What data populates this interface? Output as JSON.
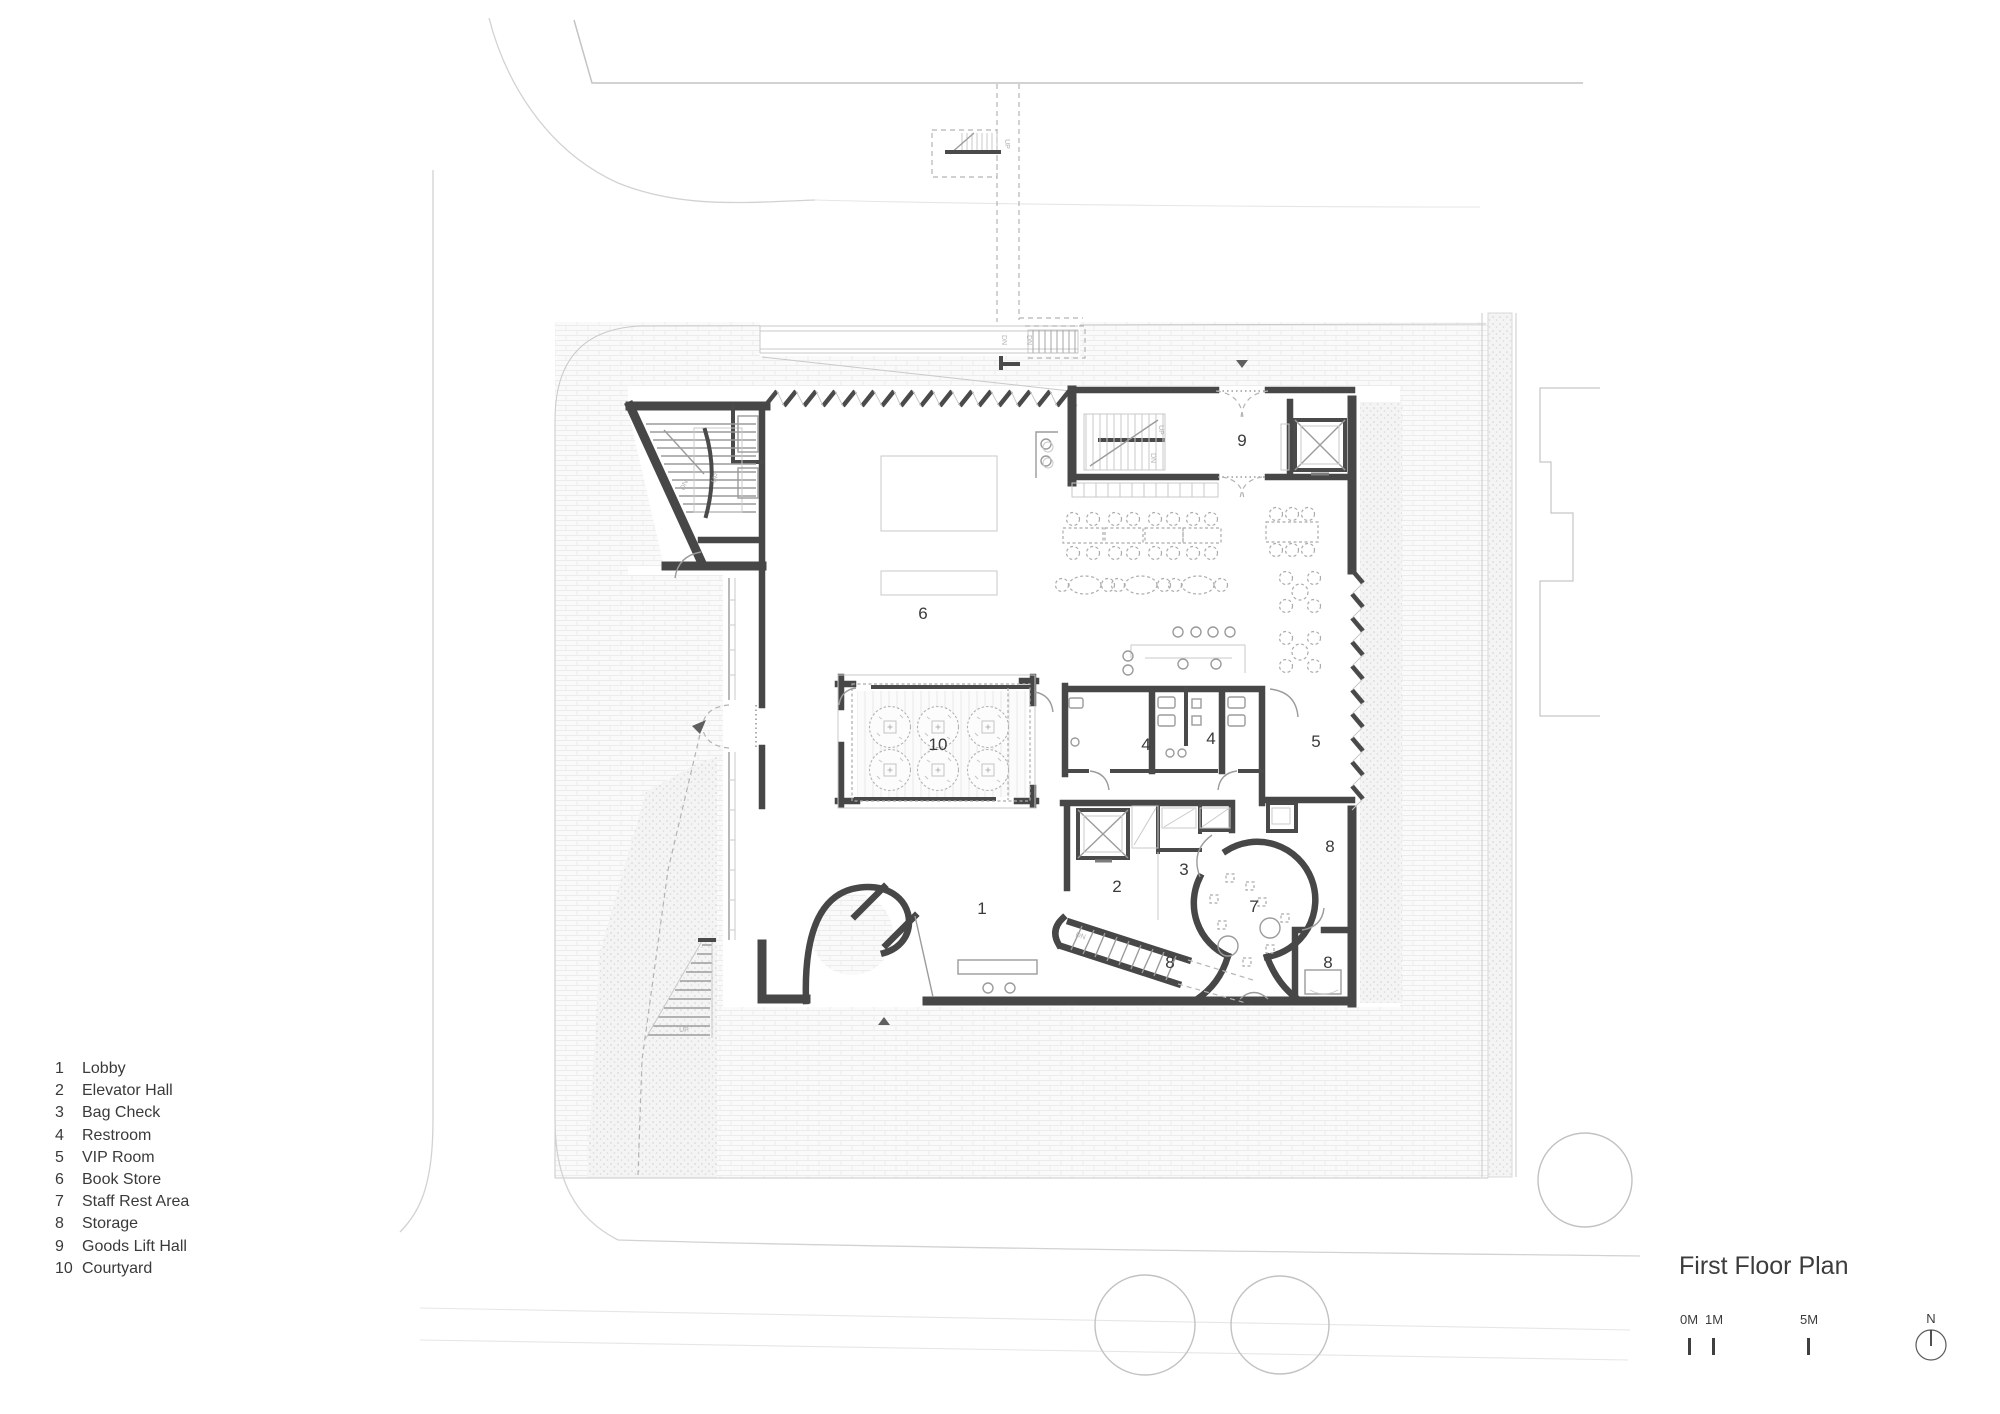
{
  "document": {
    "type": "architectural floor plan drawing"
  },
  "title": "First Floor Plan",
  "legend": {
    "items": [
      {
        "num": "1",
        "label": "Lobby"
      },
      {
        "num": "2",
        "label": "Elevator Hall"
      },
      {
        "num": "3",
        "label": "Bag Check"
      },
      {
        "num": "4",
        "label": "Restroom"
      },
      {
        "num": "5",
        "label": "VIP Room"
      },
      {
        "num": "6",
        "label": "Book Store"
      },
      {
        "num": "7",
        "label": "Staff Rest Area"
      },
      {
        "num": "8",
        "label": "Storage"
      },
      {
        "num": "9",
        "label": "Goods Lift Hall"
      },
      {
        "num": "10",
        "label": "Courtyard"
      }
    ]
  },
  "scale_bar": {
    "labels": [
      "0M",
      "1M",
      "5M"
    ],
    "north_label": "N"
  },
  "plan": {
    "room_labels": [
      {
        "num": "1",
        "x": 982,
        "y": 908
      },
      {
        "num": "2",
        "x": 1117,
        "y": 886
      },
      {
        "num": "3",
        "x": 1184,
        "y": 869
      },
      {
        "num": "4",
        "x": 1146,
        "y": 744
      },
      {
        "num": "4",
        "x": 1211,
        "y": 738
      },
      {
        "num": "5",
        "x": 1316,
        "y": 741
      },
      {
        "num": "6",
        "x": 923,
        "y": 613
      },
      {
        "num": "7",
        "x": 1254,
        "y": 906
      },
      {
        "num": "8",
        "x": 1330,
        "y": 846
      },
      {
        "num": "8",
        "x": 1170,
        "y": 962
      },
      {
        "num": "8",
        "x": 1328,
        "y": 962
      },
      {
        "num": "9",
        "x": 1242,
        "y": 440
      },
      {
        "num": "10",
        "x": 938,
        "y": 744
      }
    ],
    "stair_labels": [
      {
        "t": "UP",
        "x": 1005,
        "y": 144,
        "r": 90
      },
      {
        "t": "DN",
        "x": 1002,
        "y": 340,
        "r": 90
      },
      {
        "t": "DN",
        "x": 1027,
        "y": 340,
        "r": 90
      },
      {
        "t": "DN",
        "x": 686,
        "y": 486,
        "r": -65
      },
      {
        "t": "UP",
        "x": 717,
        "y": 479,
        "r": -65
      },
      {
        "t": "UP",
        "x": 1159,
        "y": 430,
        "r": 90
      },
      {
        "t": "DN",
        "x": 1151,
        "y": 458,
        "r": 90
      },
      {
        "t": "DN",
        "x": 1080,
        "y": 938,
        "r": 18
      },
      {
        "t": "UP",
        "x": 684,
        "y": 1032,
        "r": 0
      }
    ]
  }
}
